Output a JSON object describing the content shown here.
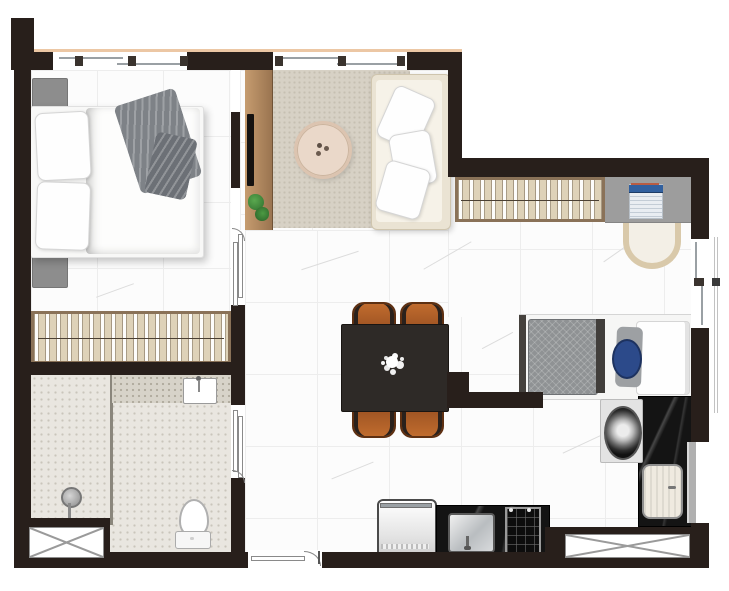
{
  "meta": {
    "kind": "apartment-floor-plan",
    "view": "top-down-render",
    "canvas_width": 729,
    "canvas_height": 591
  },
  "palette": {
    "wall": "#281f1b",
    "marble_floor": "#fcfcfc",
    "bathroom_floor": "#e9e6e0",
    "closet_wood": "#ded2b8",
    "wood_frame": "#8a7258",
    "sideboard_wood": "#b98f63",
    "rug": "#d7d1c5",
    "sofa_cream": "#eae3d3",
    "black_marble_counter": "#141414",
    "dining_table": "#2e2a27",
    "dining_chair": "#b4652c",
    "desk_gray": "#9d9d9d",
    "laptop_blue": "#31609f",
    "accent_pillow_blue": "#2c4a8a",
    "plant_green": "#48913d",
    "facade_line_salmon": "#ecc7a4"
  },
  "rooms": {
    "bedroom": {
      "name": "bedroom"
    },
    "closet1": {
      "name": "bedroom-closet"
    },
    "bathroom": {
      "name": "bathroom"
    },
    "shower": {
      "name": "shower-stall"
    },
    "living": {
      "name": "living-room"
    },
    "hallway": {
      "name": "hallway-dining-area"
    },
    "office": {
      "name": "home-office-nook"
    },
    "bedroom2": {
      "name": "second-sleeping-nook"
    },
    "laundry": {
      "name": "laundry-corner"
    },
    "kitchen": {
      "name": "kitchen-strip"
    }
  },
  "items": {
    "bed1": {
      "name": "double-bed",
      "room": "bedroom"
    },
    "nightstand_top": {
      "name": "nightstand",
      "room": "bedroom"
    },
    "nightstand_bottom": {
      "name": "nightstand",
      "room": "bedroom"
    },
    "gray_throw": {
      "name": "gray-throw-blanket",
      "room": "bedroom"
    },
    "closet_rack_1": {
      "name": "open-wardrobe-rack-with-hangers",
      "room": "closet1"
    },
    "sideboard": {
      "name": "tv-sideboard-divider",
      "room": "living"
    },
    "tv_panel": {
      "name": "tv-panel",
      "room": "living"
    },
    "plant": {
      "name": "potted-plant",
      "room": "living"
    },
    "rug": {
      "name": "area-rug",
      "room": "living"
    },
    "coffee_table": {
      "name": "round-coffee-table",
      "room": "living"
    },
    "sofa": {
      "name": "three-seat-sofa",
      "room": "living"
    },
    "dining_table": {
      "name": "dining-table",
      "room": "hallway"
    },
    "dining_chairs": {
      "name": "dining-chair",
      "count": 4,
      "room": "hallway"
    },
    "centerpiece": {
      "name": "white-flower-centerpiece",
      "room": "hallway"
    },
    "closet_rack_2": {
      "name": "open-wardrobe-rack-with-hangers",
      "room": "office"
    },
    "desk": {
      "name": "built-in-desk",
      "room": "office"
    },
    "laptop": {
      "name": "laptop",
      "room": "office"
    },
    "desk_chair": {
      "name": "desk-chair",
      "room": "office"
    },
    "bed2": {
      "name": "single-bed",
      "room": "bedroom2"
    },
    "blue_pillow": {
      "name": "blue-accent-pillow",
      "room": "bedroom2"
    },
    "washer": {
      "name": "washing-machine",
      "room": "laundry"
    },
    "laundry_counter": {
      "name": "black-marble-counter",
      "room": "laundry"
    },
    "laundry_sink": {
      "name": "laundry-tub-sink",
      "room": "laundry"
    },
    "fridge": {
      "name": "refrigerator",
      "room": "kitchen"
    },
    "kitchen_counter": {
      "name": "black-marble-kitchen-counter",
      "room": "kitchen"
    },
    "kitchen_sink": {
      "name": "stainless-kitchen-sink",
      "room": "kitchen"
    },
    "cooktop": {
      "name": "cooktop",
      "room": "kitchen"
    },
    "vanity": {
      "name": "bathroom-vanity-counter",
      "room": "bathroom"
    },
    "vanity_sink": {
      "name": "vanity-sink",
      "room": "bathroom"
    },
    "toilet": {
      "name": "toilet",
      "room": "bathroom"
    },
    "shower_head": {
      "name": "shower-head",
      "room": "shower"
    },
    "shower_partition": {
      "name": "shower-partition",
      "room": "shower"
    }
  },
  "openings": {
    "windows": [
      {
        "name": "bedroom-window",
        "wall": "top"
      },
      {
        "name": "living-room-window",
        "wall": "top"
      },
      {
        "name": "office-window",
        "wall": "right"
      },
      {
        "name": "laundry-glass-door",
        "wall": "right"
      }
    ],
    "doors": [
      {
        "name": "bedroom-sliding-door"
      },
      {
        "name": "bathroom-sliding-door"
      },
      {
        "name": "entry-door",
        "wall": "bottom"
      }
    ],
    "shafts": [
      {
        "name": "service-shaft-bottom-left"
      },
      {
        "name": "service-shaft-bottom-right"
      }
    ]
  }
}
